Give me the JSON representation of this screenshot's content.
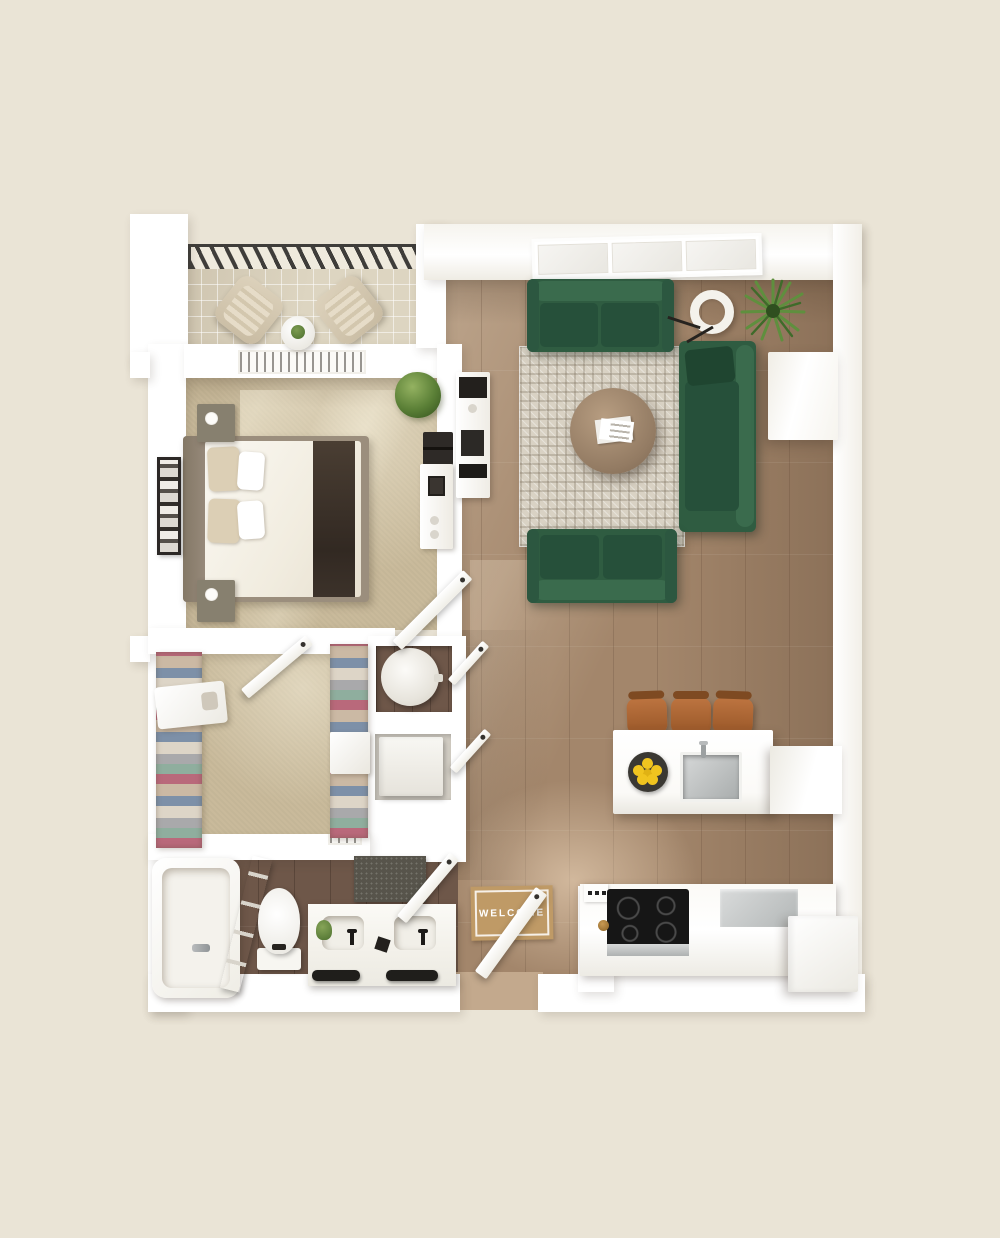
{
  "title": "One-bedroom apartment 3D top-view floor plan",
  "entry_mat": {
    "text": "WELCOME"
  },
  "palette": {
    "background": "#eae4d6",
    "wall": "#ffffff",
    "carpet": "#c9ba9b",
    "wood": "#a3866b",
    "wood_light": "#c3a98d",
    "bath_floor": "#6e5749",
    "balcony_tile": "#ddd5c1",
    "railing": "#3f3d3a",
    "rug": "#d9d2c4",
    "sofa": "#2f5c41",
    "sofa_cushion": "#26503a",
    "sofa_back": "#3a6b4d",
    "stool_leather": "#b06a38",
    "lemon": "#f0c41f",
    "mat": "#bf9a66",
    "cooktop": "#161616",
    "steel": "#c2c5c5",
    "plant": "#5f8f3e",
    "throw": "#3f342b",
    "door": "#fdfdfb"
  },
  "rooms": {
    "balcony": {
      "items": [
        "railing",
        "lounge-chair",
        "lounge-chair",
        "side-table",
        "potted-plant"
      ]
    },
    "bedroom": {
      "items": [
        "double-bed",
        "headboard",
        "pillows",
        "dark-throw",
        "nightstand",
        "nightstand",
        "wall-art",
        "potted-plant",
        "dresser",
        "desk",
        "hvac-vent",
        "door"
      ]
    },
    "closet": {
      "items": [
        "wire-shelving-left",
        "wire-shelving-right",
        "corner-shelf",
        "storage-box",
        "door"
      ]
    },
    "utility": {
      "items": [
        "water-heater",
        "washer-dryer",
        "louver-doors"
      ]
    },
    "bathroom": {
      "items": [
        "bathtub",
        "tub-faucet",
        "ladder-shelf",
        "toilet",
        "double-vanity",
        "sinks",
        "black-faucets",
        "towel-bars",
        "bath-mat",
        "door"
      ]
    },
    "entry": {
      "items": [
        "front-door",
        "welcome-mat"
      ]
    },
    "living_room": {
      "items": [
        "window",
        "sofa",
        "corner-sofa",
        "loveseat",
        "area-rug",
        "round-coffee-table",
        "magazines",
        "ring-floor-lamp",
        "spider-plant",
        "media-cabinet",
        "console-table"
      ]
    },
    "kitchen": {
      "items": [
        "island",
        "island-sink",
        "lemon-bowl",
        "bar-stool",
        "bar-stool",
        "bar-stool",
        "peninsula-counter",
        "cooktop",
        "oven",
        "dishwasher",
        "refrigerator",
        "range-vent"
      ]
    }
  }
}
